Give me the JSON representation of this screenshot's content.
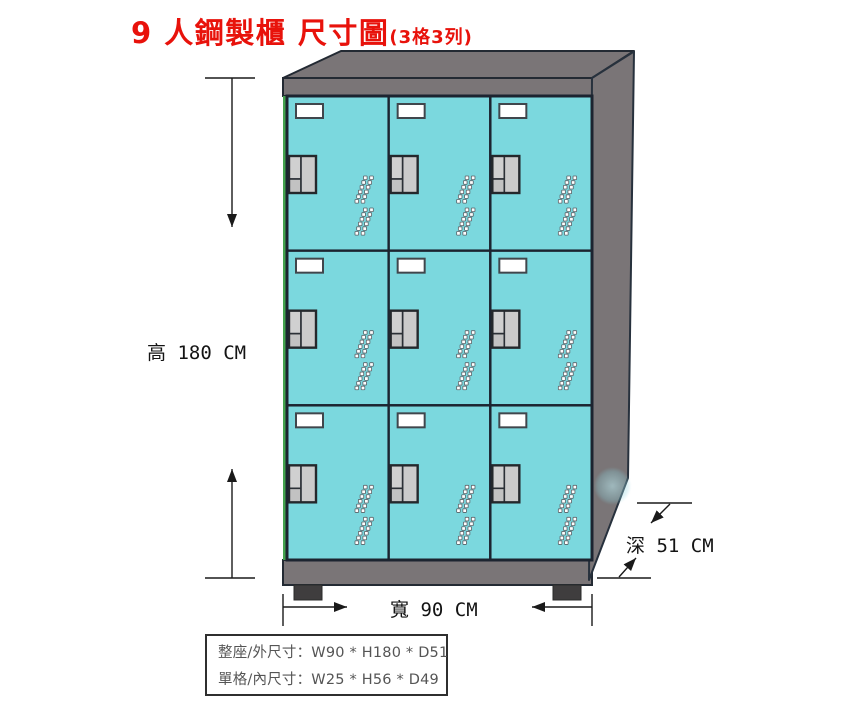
{
  "title": {
    "main": "9 人鋼製櫃 尺寸圖",
    "suffix": "(3格3列)"
  },
  "labels": {
    "height": "高 180 CM",
    "width": "寬 90 CM",
    "depth": "深 51 CM"
  },
  "spec_table": {
    "row1": "整座/外尺寸：W90 * H180 * D51",
    "row2": "單格/內尺寸：W25 * H56 * D49"
  },
  "locker": {
    "rows": 3,
    "cols": 3,
    "doors": 9
  },
  "colors": {
    "accent_red": "#e8120b",
    "door_cyan": "#7bd8de",
    "frame_gray": "#7a7577",
    "frame_dark": "#1c2430",
    "edge_green": "#43a24e",
    "foot_dark": "#3f3d3e",
    "handle_gray": "#cbcbcb",
    "card_white": "#ffffff",
    "dim_line": "#1a1a1a",
    "table_text": "#555555"
  }
}
